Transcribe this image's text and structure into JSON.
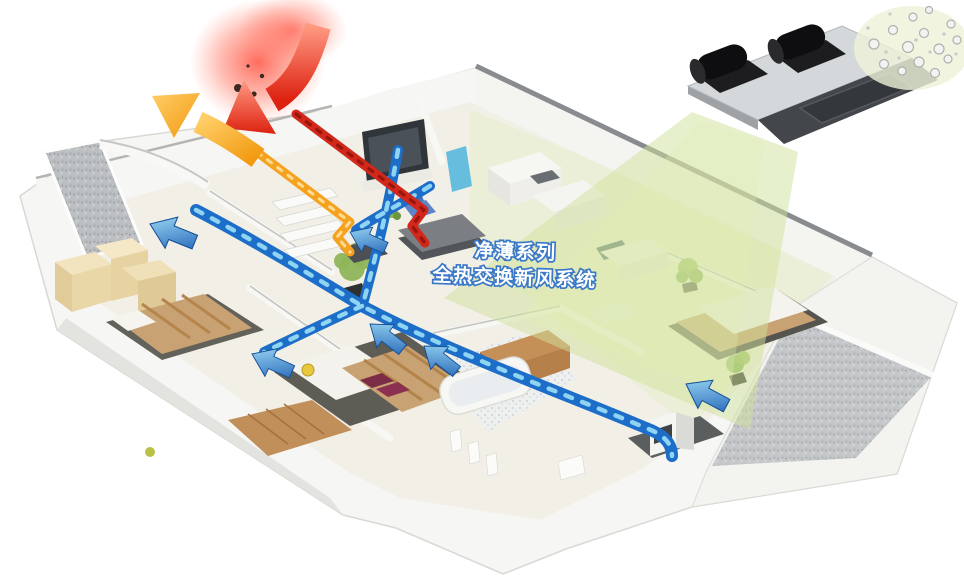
{
  "title": {
    "line1": "净薄系列",
    "line2": "全热交换新风系统"
  },
  "colors": {
    "duct_blue": "#1d6ec9",
    "duct_blue_light": "#8fd4f2",
    "duct_red": "#d2271b",
    "duct_orange": "#f5a31f",
    "beam_green": "#cfe29b",
    "title_stroke": "#3b79c8",
    "unit_body": "#d5d8da",
    "unit_dark": "#43474b",
    "unit_port": "#141416",
    "wall_white": "#f6f6f4",
    "texture_gray": "#bcbfc2",
    "bed_tan": "#c9a273",
    "plant_green": "#8db457"
  }
}
